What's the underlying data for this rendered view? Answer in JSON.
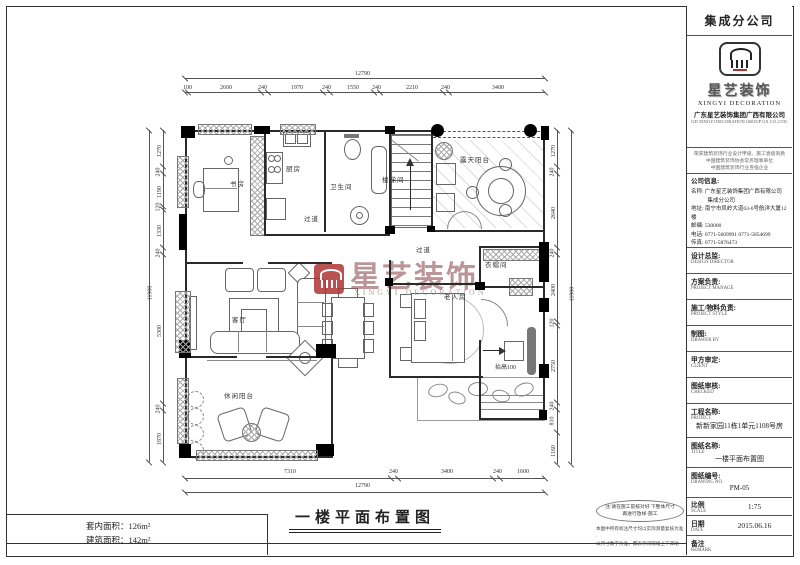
{
  "sheet": {
    "branch_header": "集成分公司",
    "logo": {
      "brand_cn": "星艺装饰",
      "brand_en": "XINGYI DECORATION",
      "company_cn": "广东星艺装饰集团广西有限公司",
      "company_en": "GD XINGYI DECORATION GROUP GX CO.,LTD."
    },
    "certs": [
      "荣获建筑装饰行业设计甲级、施工壹级资质",
      "中国建筑装饰协会常务理事单位",
      "中国建筑装饰行业百强企业"
    ],
    "company_info": {
      "title": "公司信息:",
      "lines": [
        "名称: 广东星艺装饰集团广西有限公司",
        "　　　集成分公司",
        "地址: 南宁市凤岭大道63-6号航洋大厦12楼",
        "邮编: 530000",
        "电话: 0771-5609991  0771-5854699",
        "传真: 0771-5876473",
        "网址: http://www.gxxyzs.com"
      ]
    },
    "fields": [
      {
        "label": "设计总监:",
        "sub": "DESIGN DIRECTOR",
        "value": ""
      },
      {
        "label": "方案负责:",
        "sub": "PROJECT MANAGE",
        "value": ""
      },
      {
        "label": "施工/物料负责:",
        "sub": "PROJECT STYLE",
        "value": ""
      },
      {
        "label": "制图:",
        "sub": "DRAWER BY",
        "value": ""
      },
      {
        "label": "甲方审定:",
        "sub": "CLIENT",
        "value": ""
      },
      {
        "label": "图纸审核:",
        "sub": "CHECKED",
        "value": ""
      },
      {
        "label": "工程名称:",
        "sub": "PROJECT",
        "value": "新新家园11栋1单元1108号房"
      },
      {
        "label": "图纸名称:",
        "sub": "TITLE",
        "value": "一楼平面布置图"
      },
      {
        "label": "图纸编号:",
        "sub": "DRAWING NO.",
        "value": "PM-05"
      },
      {
        "label": "比例",
        "sub": "SCALE",
        "value": "1:75"
      },
      {
        "label": "日期",
        "sub": "DATE",
        "value": "2015.06.16"
      },
      {
        "label": "备注",
        "sub": "REMARK",
        "value": ""
      }
    ],
    "areas": {
      "line1": "套内面积：126m²",
      "line2": "建筑面积：142m²"
    },
    "drawing_title": "一楼平面布置图",
    "notes": {
      "oval1": "注:请在施工前核对好 下整体尺寸",
      "oval2": "再进行放样·施工",
      "extra1": "本图中所有标注尺寸均以实际测量复核为准·",
      "extra2": "以尺寸数字为准，都表示间隔墙上下浮动·"
    }
  },
  "plan": {
    "rooms": [
      {
        "id": "study",
        "label": "书房"
      },
      {
        "id": "kitchen",
        "label": "厨房"
      },
      {
        "id": "bath",
        "label": "卫生间"
      },
      {
        "id": "stair",
        "label": "楼梯间"
      },
      {
        "id": "balcony-top",
        "label": "露天阳台"
      },
      {
        "id": "corridor-1",
        "label": "过道"
      },
      {
        "id": "corridor-2",
        "label": "过道"
      },
      {
        "id": "cloak",
        "label": "衣帽间"
      },
      {
        "id": "living",
        "label": "客厅"
      },
      {
        "id": "bedroom",
        "label": "老人房"
      },
      {
        "id": "balcony-bottom",
        "label": "休闲阳台"
      }
    ],
    "annotations": {
      "raise": "抬高100"
    },
    "watermark": {
      "brand_cn": "星艺装饰",
      "brand_en": "XINGYI DECORATION"
    },
    "dimensions": {
      "top_total": "12790",
      "top": [
        "100",
        "2600",
        "240",
        "1970",
        "240",
        "1550",
        "240",
        "2210",
        "240",
        "3400"
      ],
      "bottom": [
        "7310",
        "240",
        "3400",
        "240",
        "1600"
      ],
      "bottom_total": "12790",
      "left": [
        "1270",
        "240",
        "1190",
        "120",
        "1330",
        "240",
        "5300",
        "240",
        "1870"
      ],
      "left_total": "11900",
      "right": [
        "1270",
        "240",
        "2640",
        "240",
        "2400",
        "120",
        "2750",
        "240",
        "810",
        "1160"
      ],
      "right_total": "11900"
    }
  }
}
